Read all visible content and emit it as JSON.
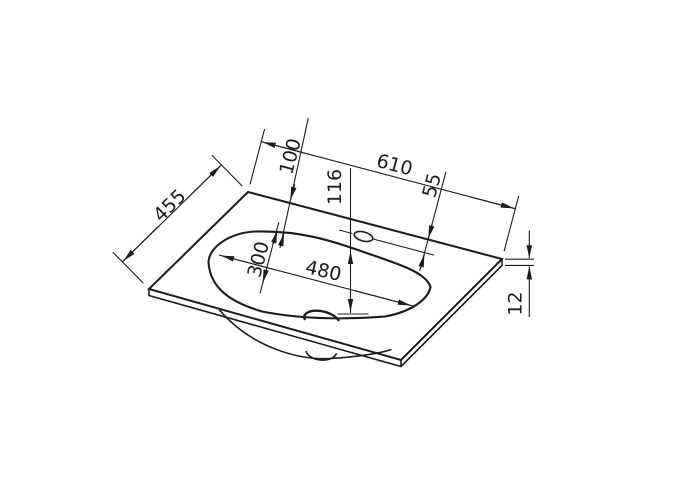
{
  "drawing": {
    "title": "Washbasin countertop technical drawing",
    "background": "#ffffff",
    "line_color": "#1c1c1c",
    "dims": {
      "total_width": "610",
      "total_depth": "455",
      "edge_to_basin": "100",
      "tap_vertical": "116",
      "tap_from_back": "55",
      "basin_width": "480",
      "basin_depth": "300",
      "thickness": "12"
    }
  }
}
